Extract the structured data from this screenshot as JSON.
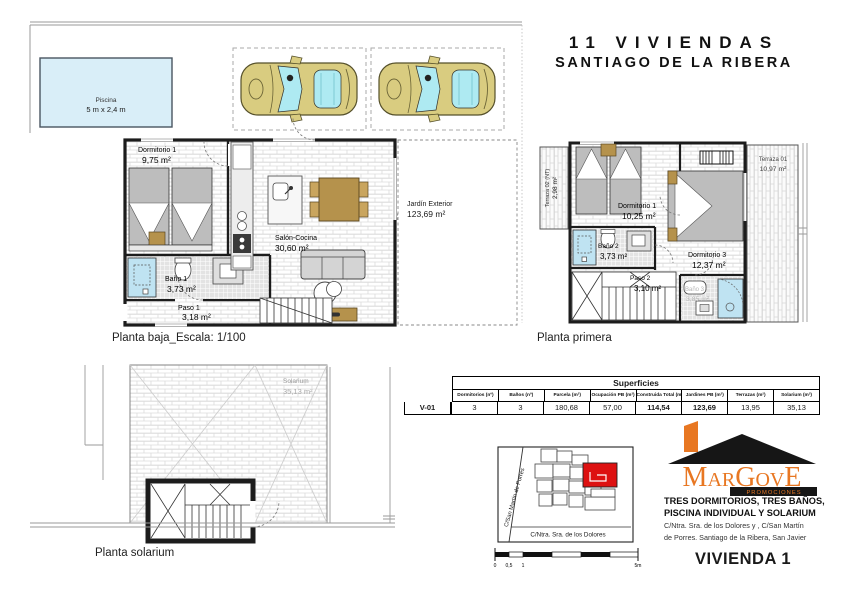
{
  "title": {
    "line1": "11 VIVIENDAS",
    "line2": "SANTIAGO DE LA RIBERA"
  },
  "ground_floor": {
    "caption": "Planta baja_Escala: 1/100",
    "pool": {
      "name": "Piscina",
      "dimensions": "5 m x 2,4 m"
    },
    "rooms": [
      {
        "name": "Dormitorio 1",
        "area": "9,75 m²"
      },
      {
        "name": "Baño 1",
        "area": "3,73 m²"
      },
      {
        "name": "Paso 1",
        "area": "3,18 m²"
      },
      {
        "name": "Salón-Cocina",
        "area": "30,60 m²"
      },
      {
        "name": "Jardín Exterior",
        "area": "123,69 m²"
      }
    ]
  },
  "first_floor": {
    "caption": "Planta primera",
    "rooms": [
      {
        "name": "Terraza 02 (NT)",
        "area": "2,98 m²"
      },
      {
        "name": "Dormitorio 1",
        "area": "10,25 m²"
      },
      {
        "name": "Baño 2",
        "area": "3,73 m²"
      },
      {
        "name": "Paso 2",
        "area": "3,10 m²"
      },
      {
        "name": "Dormitorio 3",
        "area": "12,37 m²"
      },
      {
        "name": "Baño 3",
        "area": "3,85 m²"
      },
      {
        "name": "Terraza 01",
        "area": "10,97 m²"
      }
    ]
  },
  "solarium_floor": {
    "caption": "Planta solarium",
    "rooms": [
      {
        "name": "Solarium",
        "area": "35,13 m²"
      }
    ]
  },
  "surfaces_table": {
    "title": "Superficies",
    "row_label": "V-01",
    "columns": [
      "Dormitorios (nº)",
      "Baños (nº)",
      "Parcela (m²)",
      "Ocupación PB (m²)",
      "Construida Total (m²)",
      "Jardines PB (m²)",
      "Terrazas (m²)",
      "Solarium (m²)"
    ],
    "values": [
      "3",
      "3",
      "180,68",
      "57,00",
      "114,54",
      "123,69",
      "13,95",
      "35,13"
    ]
  },
  "site_map": {
    "street_left": "C/San Martín de Porres",
    "street_bottom": "C/Ntra. Sra. de los Dolores",
    "scale_ticks": [
      "0",
      "0,5",
      "1",
      "5m"
    ]
  },
  "brand": {
    "logo_text": "MarGovE",
    "logo_sub": "PROMOCIONES",
    "features_line1": "TRES DORMITORIOS, TRES BAÑOS,",
    "features_line2": "PISCINA INDIVIDUAL Y SOLARIUM",
    "address_line1": "C/Ntra. Sra. de los Dolores y , C/San Martín",
    "address_line2": "de Porres. Santiago de la Ribera, San Javier",
    "unit_label": "VIVIENDA 1"
  },
  "colors": {
    "accent_orange": "#e87722",
    "highlight_red": "#dd1111",
    "pool_blue": "#d9eef8",
    "fixture_blue": "#bfe3f2",
    "car_body": "#d9cc80",
    "car_window": "#aeeaf2",
    "wood_tan": "#b5924c",
    "wall_black": "#1c1c1c"
  }
}
